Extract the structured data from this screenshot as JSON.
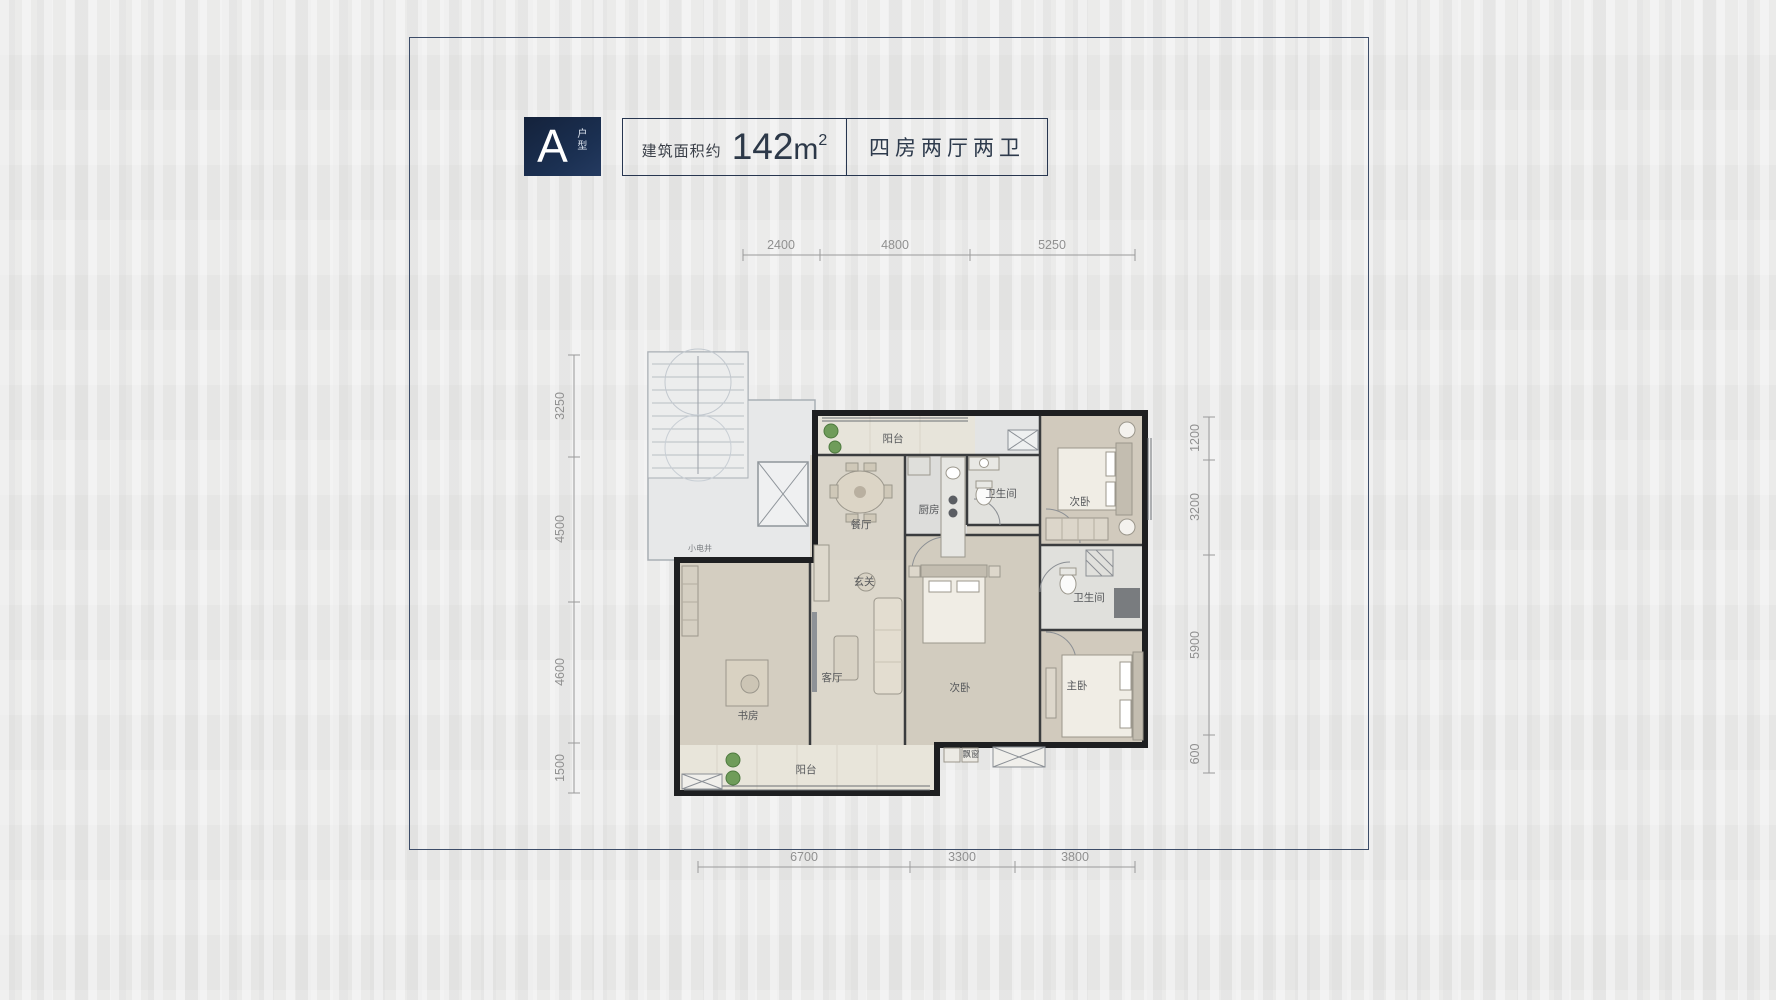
{
  "window": {
    "background": "#e9e9e8",
    "frame_color": "#3c4c68"
  },
  "header": {
    "badge": {
      "letter": "A",
      "vertical_label": "户型",
      "bg": "#1b3052",
      "text_color": "#ffffff"
    },
    "area": {
      "label": "建筑面积约",
      "value": "142",
      "unit": "m",
      "superscript": "2"
    },
    "layout": {
      "label": "四房两厅两卫"
    }
  },
  "plan": {
    "rooms": {
      "balcony_top": "阳台",
      "dining": "餐厅",
      "kitchen": "厨房",
      "bath_main": "卫生间",
      "bedroom_top": "次卧",
      "foyer": "玄关",
      "bath_second": "卫生间",
      "living": "客厅",
      "study": "书房",
      "bedroom_mid": "次卧",
      "master": "主卧",
      "balcony_bottom": "阳台",
      "bay_window": "飘窗",
      "shaft": "小电井"
    },
    "dimensions": {
      "top": [
        "2400",
        "4800",
        "5250"
      ],
      "bottom": [
        "6700",
        "3300",
        "3800"
      ],
      "left": [
        "3250",
        "4500",
        "4600",
        "1500"
      ],
      "right": [
        "1200",
        "3200",
        "5900",
        "600"
      ]
    },
    "colors": {
      "wall": "#1e1f21",
      "dimension": "#909090",
      "wood_floor": "#d5cfc2",
      "tile_floor": "#e0e0dc",
      "balcony_floor": "#e7e4da",
      "common_area": "#e7e8e9",
      "plant": "#6f9c5a"
    }
  }
}
